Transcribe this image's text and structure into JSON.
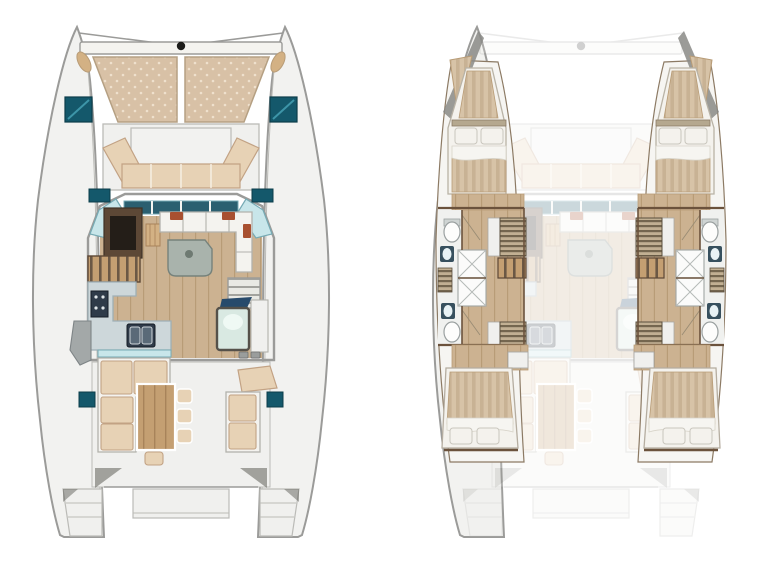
{
  "figure": {
    "type": "boat-floor-plan",
    "subject": "catamaran-yacht",
    "views": [
      {
        "name": "main-deck-plan",
        "position": "left",
        "parts": [
          "bow-crossbeam",
          "trampoline",
          "deck-hatches",
          "foredeck-lounge",
          "windshield",
          "saloon",
          "tv-cabinet",
          "saloon-sofa",
          "chart-table",
          "galley",
          "cooktop",
          "sink",
          "companionway-steps",
          "glass-door",
          "cockpit-bench",
          "cockpit-table",
          "stools",
          "helm-seat",
          "stern-platforms"
        ]
      },
      {
        "name": "lower-deck-cabins-plan",
        "position": "right",
        "style": "main-deck-shown-ghosted",
        "parts": [
          "forward-berth",
          "pillows",
          "wet-head-forward",
          "shower-boxes",
          "wet-head-aft",
          "toilet",
          "washbasin",
          "wardrobe-louvers",
          "hull-steps",
          "corridor-floor",
          "aft-berth",
          "nightstand"
        ]
      }
    ]
  },
  "colors": {
    "page_bg": "#ffffff",
    "hull_fill": "#f2f2f0",
    "hull_line": "#9b9b99",
    "deck_line": "#bbbbb7",
    "platform_fill": "#f0f0ee",
    "trampoline": "#d8c1a6",
    "trampoline_dot": "#efe0cd",
    "trampoline_edge": "#b5a083",
    "cushion": "#e7d2b5",
    "cushion_edge": "#c2a284",
    "seat_white": "#f4f3ef",
    "seat_white_edge": "#b2b2ac",
    "hatch_teal": "#14586b",
    "hatch_teal_hi": "#3d95a8",
    "glass": "#c8e6ea",
    "glass_edge": "#76aab4",
    "windshield_dark": "#2b5f70",
    "wood_floor": "#ccb291",
    "wood_line": "#b89c77",
    "wood_table": "#c49f72",
    "wood_table_line": "#a8835a",
    "dark_wood": "#5d4836",
    "wall_brown": "#6b523c",
    "counter": "#cdd7da",
    "counter_edge": "#9fb0b6",
    "appliance": "#2f3b49",
    "table_grey": "#a9b3ac",
    "table_grey_edge": "#76827b",
    "rust": "#a85030",
    "mattress": "#d7c3a7",
    "mattress_stripe": "#c8b294",
    "pillow": "#f4f2ed",
    "pillow_edge": "#c9c6bd",
    "bath": "#f0f1ef",
    "fixture_edge": "#9aa0a0",
    "sink_dark": "#37505e",
    "sink_basin": "#e8f2f5",
    "louver_dark": "#74664f",
    "louver_light": "#c2b093",
    "tread_base": "#e9e9e4",
    "tread_line": "#a3a39e",
    "step_gap": "#6b5845",
    "shadow": "#60605a",
    "navy_glass": "#274a6b",
    "door_glass": "#d9e9e2",
    "door_glass_hi": "#f2fbf7",
    "interior_bone": "#f6f5f2",
    "cabinet_grey": "#a3a8a8",
    "black_fitting": "#1c1c1a",
    "fender_tan": "#d3b184"
  }
}
